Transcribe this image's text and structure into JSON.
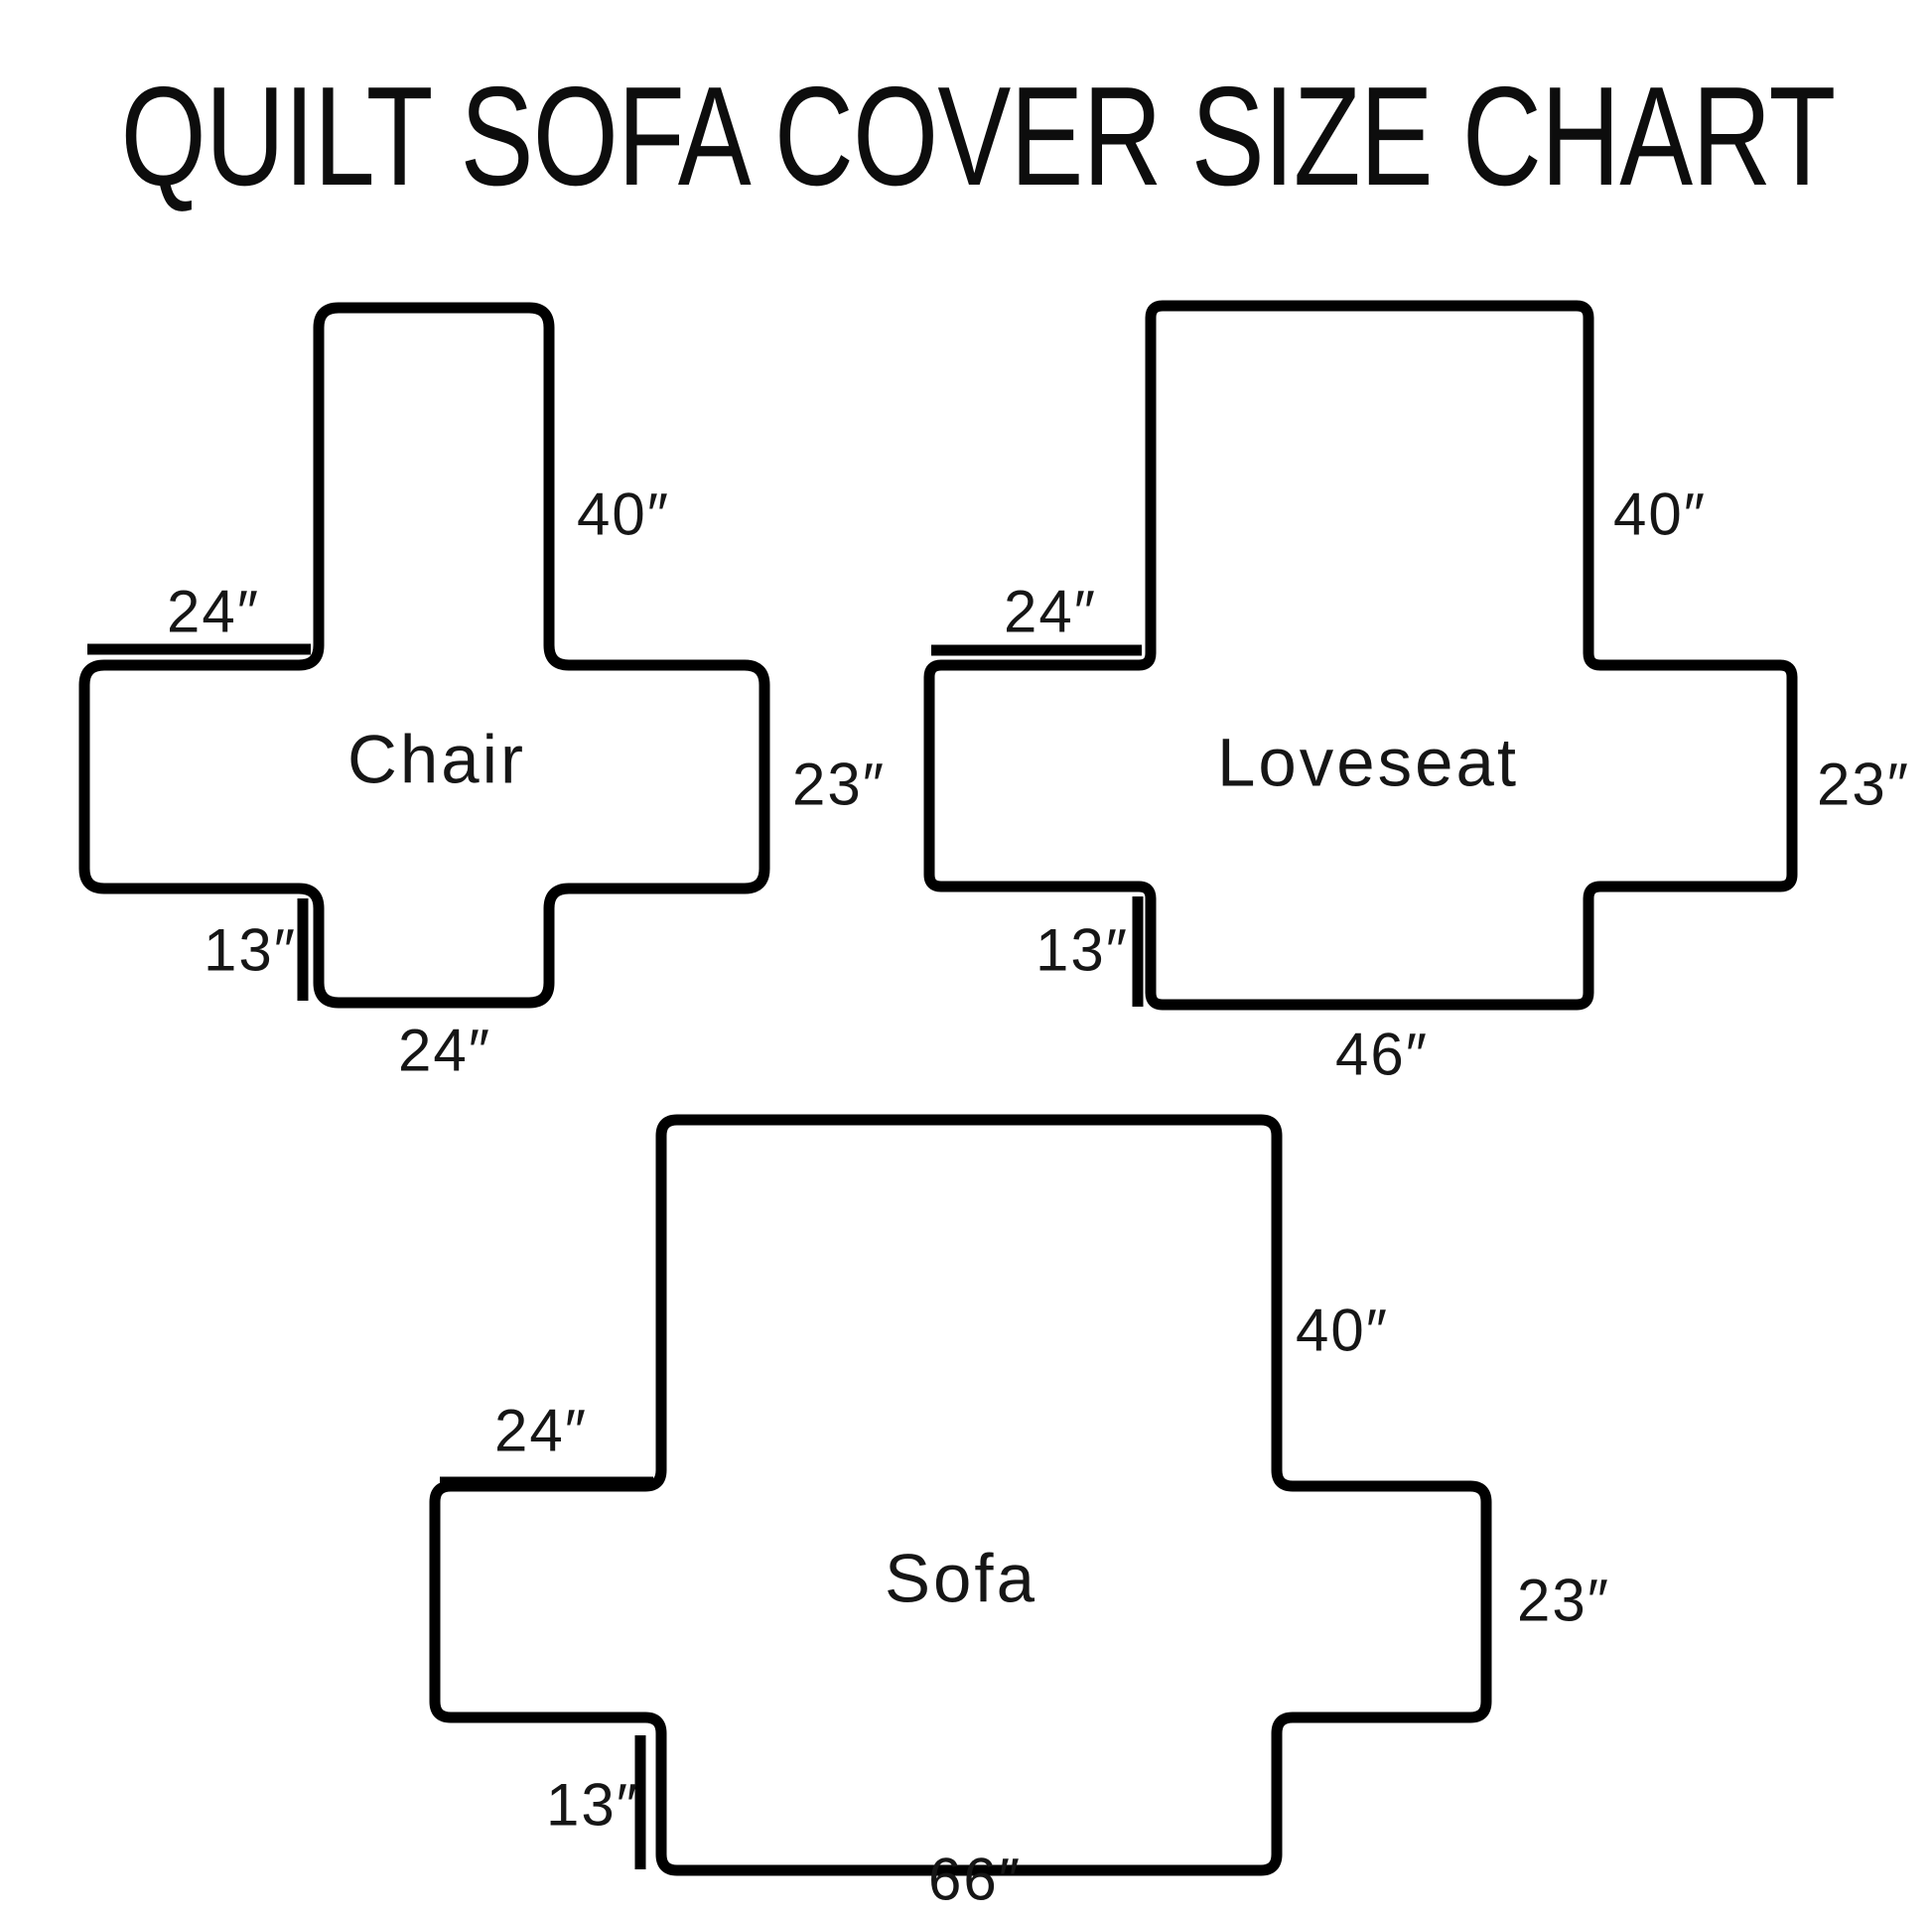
{
  "title": "QUILT SOFA COVER SIZE CHART",
  "colors": {
    "line": "#000000",
    "background": "#ffffff",
    "text": "#161616"
  },
  "diagrams": [
    {
      "id": "chair",
      "name": "Chair",
      "dimensions": {
        "back_height": "40″",
        "arm_length": "24″",
        "side_height": "23″",
        "front_drop": "13″",
        "bottom_width": "24″"
      }
    },
    {
      "id": "loveseat",
      "name": "Loveseat",
      "dimensions": {
        "back_height": "40″",
        "arm_length": "24″",
        "side_height": "23″",
        "front_drop": "13″",
        "bottom_width": "46″"
      }
    },
    {
      "id": "sofa",
      "name": "Sofa",
      "dimensions": {
        "back_height": "40″",
        "arm_length": "24″",
        "side_height": "23″",
        "front_drop": "13″",
        "bottom_width": "66″"
      }
    }
  ]
}
